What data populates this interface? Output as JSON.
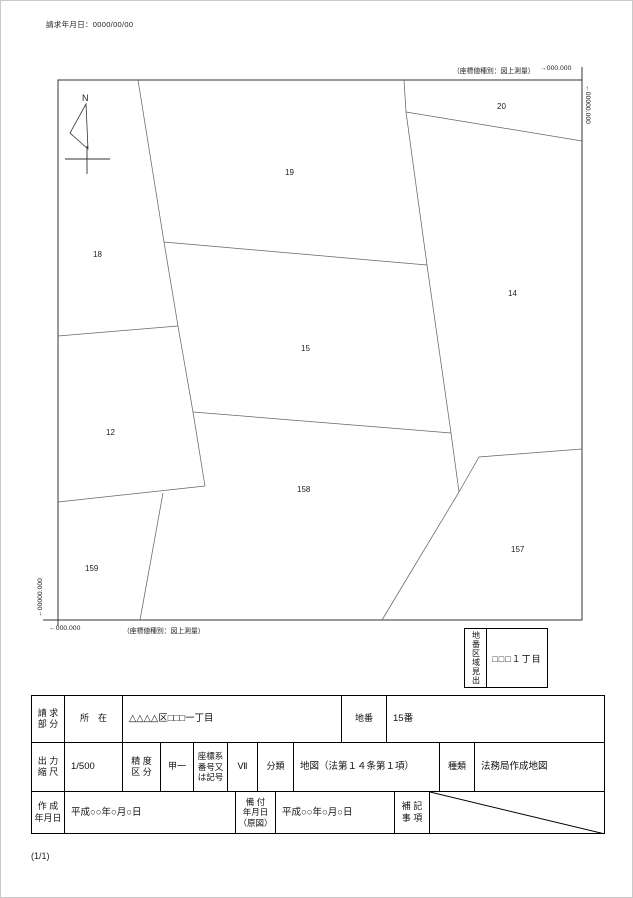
{
  "header": {
    "request_date": "請求年月日：0000/00/00"
  },
  "map": {
    "north_label": "N",
    "coord_type_note_top": "（座標値種別：図上測量）",
    "coord_type_note_bottom": "（座標値種別：図上測量）",
    "corner_labels": {
      "top_right_x": "→000.000",
      "right_y": "←00000.000",
      "bottom_left_x": "←000.000",
      "left_y": "←00000.000"
    },
    "border": {
      "x1": 57,
      "y1": 79,
      "x2": 581,
      "y2": 619
    },
    "boundaries": [
      "137,79 163,241 177,325 192,411 204,485",
      "403,79 405,111 426,264 450,432 458,491",
      "163,241 426,264",
      "57,335 177,325",
      "192,411 450,432",
      "57,501 204,485",
      "162,492 139,619",
      "405,111 581,140",
      "458,491 478,456 581,448",
      "458,491 381,619"
    ],
    "parcels": [
      {
        "number": "18",
        "x": 92,
        "y": 256
      },
      {
        "number": "19",
        "x": 284,
        "y": 174
      },
      {
        "number": "20",
        "x": 496,
        "y": 108
      },
      {
        "number": "14",
        "x": 507,
        "y": 295
      },
      {
        "number": "15",
        "x": 300,
        "y": 350
      },
      {
        "number": "12",
        "x": 105,
        "y": 434
      },
      {
        "number": "158",
        "x": 296,
        "y": 491
      },
      {
        "number": "159",
        "x": 84,
        "y": 570
      },
      {
        "number": "157",
        "x": 510,
        "y": 551
      }
    ]
  },
  "index_box": {
    "vertical_label": "地番区域見出",
    "value": "□□□１丁目"
  },
  "table": {
    "request_part_label": "請 求\n部 分",
    "location_label": "所　在",
    "location_value": "△△△△区□□□一丁目",
    "lot_number_label": "地番",
    "lot_number_value": "15番",
    "scale_label": "出 力\n縮 尺",
    "scale_value": "1/500",
    "precision_label": "精 度\n区 分",
    "precision_value": "甲一",
    "coord_system_label": "座標系\n番号又\nは記号",
    "coord_system_value": "Ⅶ",
    "classification_label": "分類",
    "classification_value": "地図（法第１４条第１項）",
    "kind_label": "種類",
    "kind_value": "法務局作成地図",
    "created_date_label": "作 成\n年月日",
    "created_date_value": "平成○○年○月○日",
    "filed_date_label": "備 付\n年月日\n（原図）",
    "filed_date_value": "平成○○年○月○日",
    "remarks_label": "補 記\n事 項"
  },
  "footer": {
    "page_indicator": "(1/1)"
  }
}
